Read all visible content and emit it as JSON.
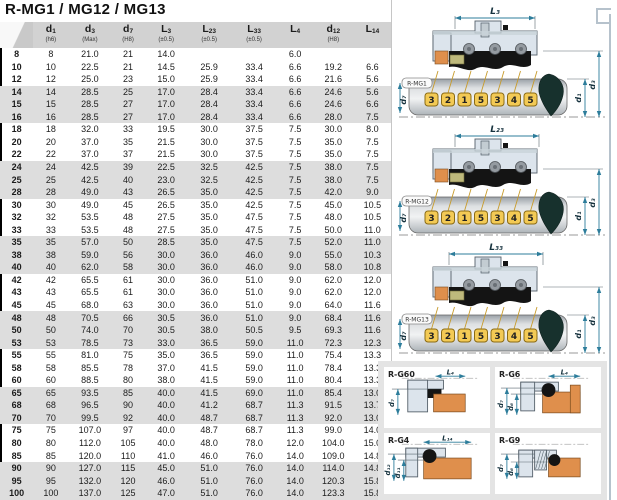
{
  "title": "R-MG1 / MG12 / MG13",
  "table": {
    "columns": [
      {
        "main": "",
        "sub": "",
        "note": ""
      },
      {
        "main": "d",
        "sub": "1",
        "note": "(h6)"
      },
      {
        "main": "d",
        "sub": "3",
        "note": "(Max)"
      },
      {
        "main": "d",
        "sub": "7",
        "note": "(H8)"
      },
      {
        "main": "L",
        "sub": "3",
        "note": "(±0.5)"
      },
      {
        "main": "L",
        "sub": "23",
        "note": "(±0.5)"
      },
      {
        "main": "L",
        "sub": "33",
        "note": "(±0.5)"
      },
      {
        "main": "L",
        "sub": "4",
        "note": ""
      },
      {
        "main": "d",
        "sub": "12",
        "note": "(H8)"
      },
      {
        "main": "L",
        "sub": "14",
        "note": ""
      }
    ],
    "rows": [
      [
        "8",
        "8",
        "21.0",
        "21",
        "14.0",
        "",
        "",
        "6.0",
        "",
        ""
      ],
      [
        "10",
        "10",
        "22.5",
        "21",
        "14.5",
        "25.9",
        "33.4",
        "6.6",
        "19.2",
        "6.6"
      ],
      [
        "12",
        "12",
        "25.0",
        "23",
        "15.0",
        "25.9",
        "33.4",
        "6.6",
        "21.6",
        "5.6"
      ],
      [
        "14",
        "14",
        "28.5",
        "25",
        "17.0",
        "28.4",
        "33.4",
        "6.6",
        "24.6",
        "5.6"
      ],
      [
        "15",
        "15",
        "28.5",
        "27",
        "17.0",
        "28.4",
        "33.4",
        "6.6",
        "24.6",
        "6.6"
      ],
      [
        "16",
        "16",
        "28.5",
        "27",
        "17.0",
        "28.4",
        "33.4",
        "6.6",
        "28.0",
        "7.5"
      ],
      [
        "18",
        "18",
        "32.0",
        "33",
        "19.5",
        "30.0",
        "37.5",
        "7.5",
        "30.0",
        "8.0"
      ],
      [
        "20",
        "20",
        "37.0",
        "35",
        "21.5",
        "30.0",
        "37.5",
        "7.5",
        "35.0",
        "7.5"
      ],
      [
        "22",
        "22",
        "37.0",
        "37",
        "21.5",
        "30.0",
        "37.5",
        "7.5",
        "35.0",
        "7.5"
      ],
      [
        "24",
        "24",
        "42.5",
        "39",
        "22.5",
        "32.5",
        "42.5",
        "7.5",
        "38.0",
        "7.5"
      ],
      [
        "25",
        "25",
        "42.5",
        "40",
        "23.0",
        "32.5",
        "42.5",
        "7.5",
        "38.0",
        "7.5"
      ],
      [
        "28",
        "28",
        "49.0",
        "43",
        "26.5",
        "35.0",
        "42.5",
        "7.5",
        "42.0",
        "9.0"
      ],
      [
        "30",
        "30",
        "49.0",
        "45",
        "26.5",
        "35.0",
        "42.5",
        "7.5",
        "45.0",
        "10.5"
      ],
      [
        "32",
        "32",
        "53.5",
        "48",
        "27.5",
        "35.0",
        "47.5",
        "7.5",
        "48.0",
        "10.5"
      ],
      [
        "33",
        "33",
        "53.5",
        "48",
        "27.5",
        "35.0",
        "47.5",
        "7.5",
        "50.0",
        "11.0"
      ],
      [
        "35",
        "35",
        "57.0",
        "50",
        "28.5",
        "35.0",
        "47.5",
        "7.5",
        "52.0",
        "11.0"
      ],
      [
        "38",
        "38",
        "59.0",
        "56",
        "30.0",
        "36.0",
        "46.0",
        "9.0",
        "55.0",
        "10.3"
      ],
      [
        "40",
        "40",
        "62.0",
        "58",
        "30.0",
        "36.0",
        "46.0",
        "9.0",
        "58.0",
        "10.8"
      ],
      [
        "42",
        "42",
        "65.5",
        "61",
        "30.0",
        "36.0",
        "51.0",
        "9.0",
        "62.0",
        "12.0"
      ],
      [
        "43",
        "43",
        "65.5",
        "61",
        "30.0",
        "36.0",
        "51.0",
        "9.0",
        "62.0",
        "12.0"
      ],
      [
        "45",
        "45",
        "68.0",
        "63",
        "30.0",
        "36.0",
        "51.0",
        "9.0",
        "64.0",
        "11.6"
      ],
      [
        "48",
        "48",
        "70.5",
        "66",
        "30.5",
        "36.0",
        "51.0",
        "9.0",
        "68.4",
        "11.6"
      ],
      [
        "50",
        "50",
        "74.0",
        "70",
        "30.5",
        "38.0",
        "50.5",
        "9.5",
        "69.3",
        "11.6"
      ],
      [
        "53",
        "53",
        "78.5",
        "73",
        "33.0",
        "36.5",
        "59.0",
        "11.0",
        "72.3",
        "12.3"
      ],
      [
        "55",
        "55",
        "81.0",
        "75",
        "35.0",
        "36.5",
        "59.0",
        "11.0",
        "75.4",
        "13.3"
      ],
      [
        "58",
        "58",
        "85.5",
        "78",
        "37.0",
        "41.5",
        "59.0",
        "11.0",
        "78.4",
        "13.3"
      ],
      [
        "60",
        "60",
        "88.5",
        "80",
        "38.0",
        "41.5",
        "59.0",
        "11.0",
        "80.4",
        "13.3"
      ],
      [
        "65",
        "65",
        "93.5",
        "85",
        "40.0",
        "41.5",
        "69.0",
        "11.0",
        "85.4",
        "13.0"
      ],
      [
        "68",
        "68",
        "96.5",
        "90",
        "40.0",
        "41.2",
        "68.7",
        "11.3",
        "91.5",
        "13.7"
      ],
      [
        "70",
        "70",
        "99.5",
        "92",
        "40.0",
        "48.7",
        "68.7",
        "11.3",
        "92.0",
        "13.0"
      ],
      [
        "75",
        "75",
        "107.0",
        "97",
        "40.0",
        "48.7",
        "68.7",
        "11.3",
        "99.0",
        "14.0"
      ],
      [
        "80",
        "80",
        "112.0",
        "105",
        "40.0",
        "48.0",
        "78.0",
        "12.0",
        "104.0",
        "15.0"
      ],
      [
        "85",
        "85",
        "120.0",
        "110",
        "41.0",
        "46.0",
        "76.0",
        "14.0",
        "109.0",
        "14.8"
      ],
      [
        "90",
        "90",
        "127.0",
        "115",
        "45.0",
        "51.0",
        "76.0",
        "14.0",
        "114.0",
        "14.8"
      ],
      [
        "95",
        "95",
        "132.0",
        "120",
        "46.0",
        "51.0",
        "76.0",
        "14.0",
        "120.3",
        "15.8"
      ],
      [
        "100",
        "100",
        "137.0",
        "125",
        "47.0",
        "51.0",
        "76.0",
        "14.0",
        "123.3",
        "15.8"
      ]
    ]
  },
  "diagrams": [
    {
      "label": "R-MG1",
      "top_dim": "L₃",
      "left_dim": "d₇",
      "right_dims": [
        "d₁",
        "d₃"
      ],
      "shaft_numbers": [
        "3",
        "2",
        "1",
        "5",
        "3",
        "4",
        "5"
      ]
    },
    {
      "label": "R-MG12",
      "top_dim": "L₂₃",
      "left_dim": "d₇",
      "right_dims": [
        "d₁",
        "d₃"
      ],
      "shaft_numbers": [
        "3",
        "2",
        "1",
        "5",
        "3",
        "4",
        "5"
      ]
    },
    {
      "label": "R-MG13",
      "top_dim": "L₃₃",
      "left_dim": "d₇",
      "right_dims": [
        "d₁",
        "d₃"
      ],
      "shaft_numbers": [
        "3",
        "2",
        "1",
        "5",
        "3",
        "4",
        "5"
      ]
    }
  ],
  "seat_cards": [
    {
      "label": "R-G60",
      "top_dim": "L₄",
      "left_dims": [
        "d₇"
      ]
    },
    {
      "label": "R-G6",
      "top_dim": "L₄",
      "left_dims": [
        "d₇",
        "d₆"
      ]
    },
    {
      "label": "R-G4",
      "top_dim": "L₁₄",
      "left_dims": [
        "d₁₂",
        "d₁₁"
      ]
    },
    {
      "label": "R-G9",
      "top_dim": "",
      "left_dims": [
        "d₇",
        "d₆"
      ]
    }
  ],
  "colors": {
    "dim_line": "#2d7d9b",
    "dim_label": "#16323e",
    "housing": "#dce4ec",
    "housing_edge": "#55606a",
    "orange": "#df8f4c",
    "olive": "#beb97c",
    "black_part": "#141414",
    "spring": "#959ba1",
    "plate": "#f3ca55",
    "plate_edge": "#8a6a14",
    "leader": "#c79b2c",
    "cone": "#17312d",
    "stripe": "#dddddd",
    "header_bg": "#d2d2d2"
  }
}
